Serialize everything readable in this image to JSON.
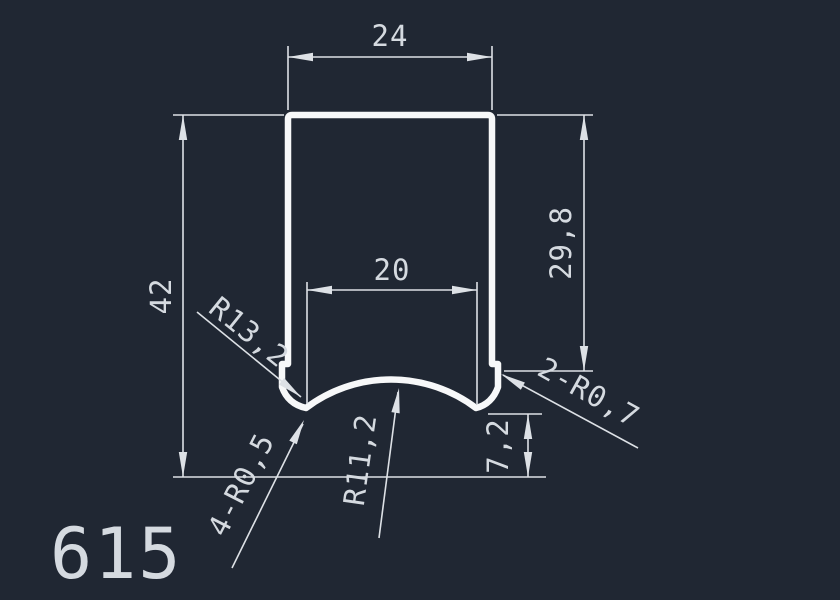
{
  "canvas": {
    "background_color": "#202733",
    "part_number": "615"
  },
  "dimensions": {
    "outer_width": "24",
    "overall_height": "42",
    "notch_width": "20",
    "side_height": "29,8",
    "foot_height": "7,2"
  },
  "radius_callouts": {
    "arc_outer": "R13,2",
    "arc_inner": "R11,2",
    "foot_fillets": "4-R0,5",
    "step_fillets": "2-R0,7"
  },
  "colors": {
    "profile": "#f7f8f9",
    "dimension_lines": "#dde1e6",
    "text": "#d5dae0"
  }
}
